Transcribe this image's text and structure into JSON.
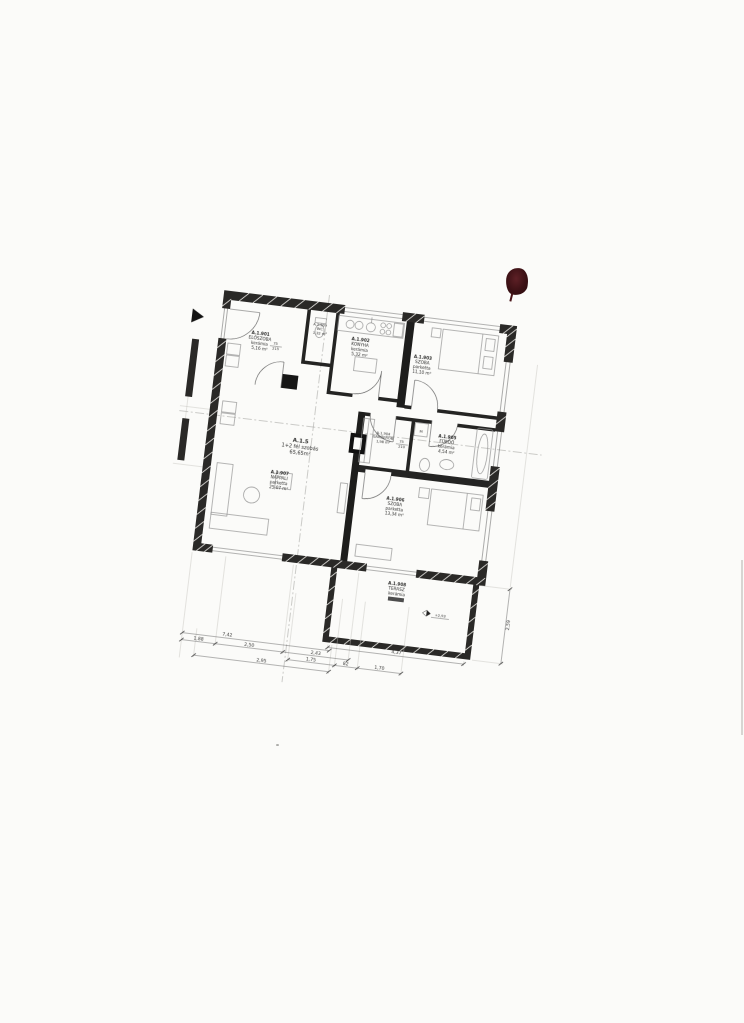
{
  "plan": {
    "apartment": {
      "id": "A.1.5",
      "type": "1+2 fél szobás",
      "area": "65,65m²"
    },
    "rooms": [
      {
        "id": "A.1.901",
        "name": "ELŐSZOBA",
        "finish": "kerámia",
        "area": "5,16 m²"
      },
      {
        "id": "A.1.909",
        "name": "WC",
        "finish": "",
        "area": "1,32 m²"
      },
      {
        "id": "A.1.902",
        "name": "KONYHA",
        "finish": "kerámia",
        "area": "5,32 m²"
      },
      {
        "id": "A.1.903",
        "name": "SZOBA",
        "finish": "parketta",
        "area": "11,10 m²"
      },
      {
        "id": "A.1.904",
        "name": "GARDERÓB",
        "finish": "",
        "area": "1,98 m²"
      },
      {
        "id": "A.1.905",
        "name": "FÜRDŐ",
        "finish": "kerámia",
        "area": "4,54 m²"
      },
      {
        "id": "A.1.906",
        "name": "SZOBA",
        "finish": "parketta",
        "area": "13,34 m²"
      },
      {
        "id": "A.1.907",
        "name": "NAPPALI",
        "finish": "parketta",
        "area": "25,07 m²"
      },
      {
        "id": "A.1.908",
        "name": "TERASZ",
        "finish": "kerámia",
        "area": ""
      }
    ],
    "dims": {
      "total": "7,42",
      "b1": "1,88",
      "b2": "2,50",
      "b3": "2,43",
      "b4": "1,75",
      "b5": "82",
      "b6": "1,70",
      "b7": "2,95",
      "b8": "4,37",
      "right": "2,59"
    },
    "doors": {
      "wc": {
        "w": "75",
        "h": "215"
      },
      "gard": {
        "w": "75",
        "h": "210"
      }
    },
    "labels": {
      "level": "+2,93",
      "washer": "M"
    }
  },
  "stamp": {
    "color": "#3c1115"
  }
}
